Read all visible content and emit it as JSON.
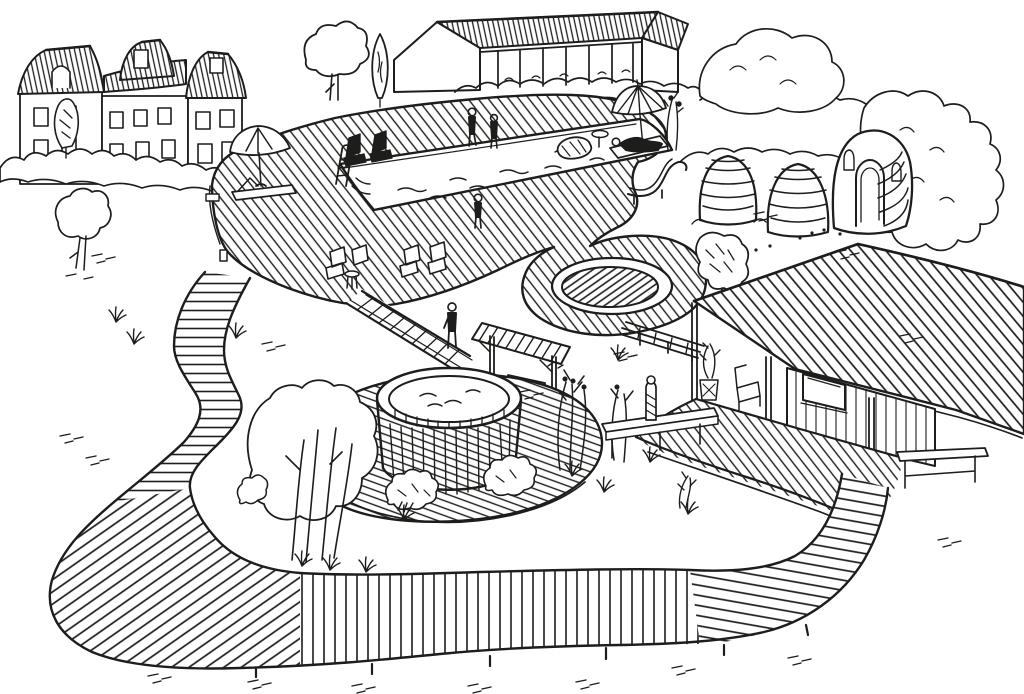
{
  "document": {
    "kind": "hand-drawn ink illustration",
    "subject": "Aerial perspective concept sketch of a natural swimming pond garden with timber decks, sauna domes, hot tub, pergola, cabin and a winding boardwalk loop",
    "width_px": 1024,
    "height_px": 694
  },
  "palette": {
    "ink": "#1d1d1b",
    "paper": "#ffffff"
  },
  "scene": {
    "buildings": [
      {
        "id": "manor-house",
        "label": "manor house with hatched mansard roofs and rows of windows"
      },
      {
        "id": "barn-pavilion",
        "label": "long open-sided barn pavilion with hatched roof and posts"
      },
      {
        "id": "sauna-dome-small",
        "label": "small beehive-shaped sauna dome"
      },
      {
        "id": "sauna-dome-large",
        "label": "second beehive-shaped sauna dome"
      },
      {
        "id": "sauna-house",
        "label": "rounded banded sauna house with arched doorway"
      },
      {
        "id": "garden-cabin",
        "label": "garden cabin with large sweeping roof, porch posts and window"
      }
    ],
    "water_features": [
      {
        "id": "swimming-pond",
        "label": "large rectangular natural swimming pond with ladder and rock"
      },
      {
        "id": "plunge-pool",
        "label": "round hatched plunge pool set into a deck lobe"
      },
      {
        "id": "hot-tub",
        "label": "round timber-stave hot tub on a circular deck"
      }
    ],
    "structures": [
      {
        "id": "pool-deck",
        "label": "hatched timber deck surrounding the swimming pond"
      },
      {
        "id": "plunge-pool-deck",
        "label": "curved deck lobe around the plunge pool"
      },
      {
        "id": "hot-tub-deck",
        "label": "circular hatched deck around the hot tub"
      },
      {
        "id": "cabin-deck",
        "label": "deck terrace in front of the cabin"
      },
      {
        "id": "pergola",
        "label": "slatted pergola with bench"
      },
      {
        "id": "walkway-bridge",
        "label": "plank walkway between pool deck and hot tub deck"
      },
      {
        "id": "plank-ramp",
        "label": "plank ramp from plunge pool deck toward the cabin"
      },
      {
        "id": "serpentine-boardwalk",
        "label": "winding boardwalk loop enclosing the lawn"
      },
      {
        "id": "counter-bench",
        "label": "long timber bench-table on the lawn"
      },
      {
        "id": "carved-post",
        "label": "carved timber post beside the bench-table"
      },
      {
        "id": "garden-bench",
        "label": "bench on the ground beside the cabin"
      }
    ],
    "furniture": [
      {
        "id": "parasol-left",
        "label": "plain parasol with sun lounger and side table"
      },
      {
        "id": "parasol-right",
        "label": "striped parasol with occupied lounger and mushroom table"
      },
      {
        "id": "dark-loungers",
        "label": "two dark loungers at the pond head"
      },
      {
        "id": "deck-chair-pairs",
        "label": "two pairs of low deck chairs on the near deck"
      },
      {
        "id": "curved-chaise",
        "label": "curved chaise longue at the pond's right end"
      },
      {
        "id": "round-stool",
        "label": "small round stool"
      }
    ],
    "people": [
      {
        "id": "person-pond-head-1",
        "label": "person standing at the head of the pond"
      },
      {
        "id": "person-pond-head-2",
        "label": "second person standing at the head of the pond"
      },
      {
        "id": "person-pond-edge",
        "label": "person standing at the pond's near edge"
      },
      {
        "id": "person-walkway",
        "label": "person walking on the plank walkway"
      },
      {
        "id": "person-on-lounger",
        "label": "person lying on the lounger under the striped parasol"
      }
    ],
    "vegetation": [
      {
        "id": "boundary-hedges",
        "label": "scalloped boundary hedges behind the decks"
      },
      {
        "id": "cypress-tree",
        "label": "columnar cypress beside the barn"
      },
      {
        "id": "round-tree",
        "label": "round deciduous tree by the barn"
      },
      {
        "id": "dark-front-tree",
        "label": "small dark tree in front of the manor"
      },
      {
        "id": "small-lawn-tree",
        "label": "small tree on the left lawn"
      },
      {
        "id": "multi-stem-tree",
        "label": "multi-stem tree inside the boardwalk loop"
      },
      {
        "id": "plunge-side-tree",
        "label": "dark shrubby tree beside the plunge pool"
      },
      {
        "id": "ornamental-grasses",
        "label": "tall ornamental grasses near the hot tub"
      },
      {
        "id": "deck-shrubs",
        "label": "shrubs along the hot tub deck edge"
      },
      {
        "id": "scrub-right",
        "label": "tall scrub mass behind the sauna area"
      },
      {
        "id": "lawn-tufts",
        "label": "scattered grass tufts and ground dashes"
      }
    ],
    "counts": {
      "people": 5,
      "parasols": 2,
      "sauna_domes": 2,
      "deck_chairs": 4,
      "windows_manor": 14
    }
  }
}
